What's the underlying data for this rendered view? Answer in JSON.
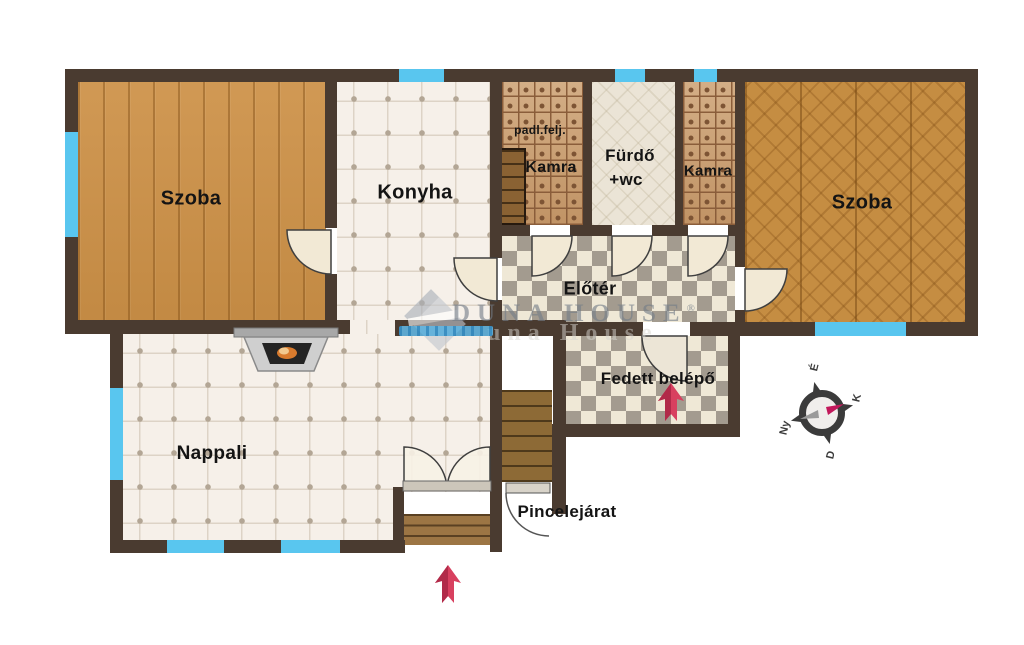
{
  "rooms": {
    "szoba_left": {
      "label": "Szoba"
    },
    "konyha": {
      "label": "Konyha"
    },
    "kamra_left": {
      "label": "Kamra",
      "note": "padl.felj."
    },
    "furdo": {
      "label": "Fürdő",
      "label2": "+wc"
    },
    "kamra_right": {
      "label": "Kamra"
    },
    "szoba_right": {
      "label": "Szoba"
    },
    "eloter": {
      "label": "Előtér"
    },
    "fedett_belepo": {
      "label": "Fedett belépő"
    },
    "nappali": {
      "label": "Nappali"
    },
    "pincelejarat": {
      "label": "Pincelejárat"
    }
  },
  "compass": {
    "n": "É",
    "e": "K",
    "s": "D",
    "w": "Ny"
  },
  "watermark": {
    "brand": "DUNA HOUSE",
    "registered": "®",
    "echo": "una House"
  },
  "colors": {
    "wall": "#4a3b30",
    "window": "#59c6ef",
    "arrow": "#d8405f",
    "wood_plank": "#cd9147",
    "wood_herringbone": "#c58d42",
    "tile": "#f6f0e9",
    "checker_gray": "#a39b8f",
    "checker_cream": "#efe8d6",
    "kamra_tile": "#c79a6b",
    "furdo_floor": "#ebe4d6"
  }
}
